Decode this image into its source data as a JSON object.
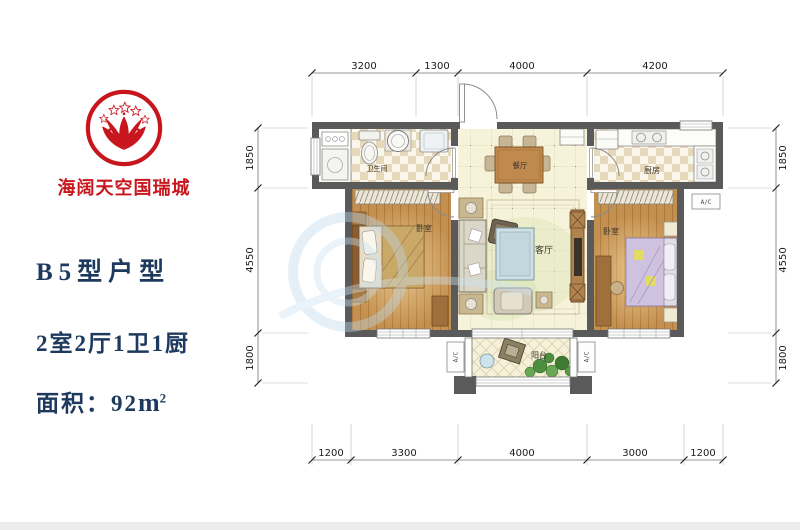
{
  "branding": {
    "name": "海阔天空国瑞城",
    "color": "#c8161e"
  },
  "unit_info": {
    "title": "B5型户型",
    "rooms": "2室2厅1卫1厨",
    "area_prefix": "面积：92",
    "area_unit": "m",
    "area_sup": "2",
    "text_color": "#1d3a5e"
  },
  "floorplan": {
    "room_labels": {
      "bathroom": "卫生间",
      "dining": "餐厅",
      "kitchen": "厨房",
      "bedroom_left": "卧室",
      "living": "客厅",
      "bedroom_right": "卧室",
      "balcony": "阳台"
    },
    "ac_label": "A/C",
    "dimensions": {
      "top": [
        "3200",
        "1300",
        "4000",
        "4200"
      ],
      "bottom": [
        "1200",
        "3300",
        "4000",
        "3000",
        "1200"
      ],
      "left": [
        "1850",
        "4550",
        "1800"
      ],
      "right": [
        "1850",
        "4550",
        "1800"
      ]
    },
    "colors": {
      "wall": "#5a5a5a",
      "wood_floor": "#c4904f",
      "tile_cream": "#f7f3da",
      "checker": "#e5d9ba"
    }
  }
}
